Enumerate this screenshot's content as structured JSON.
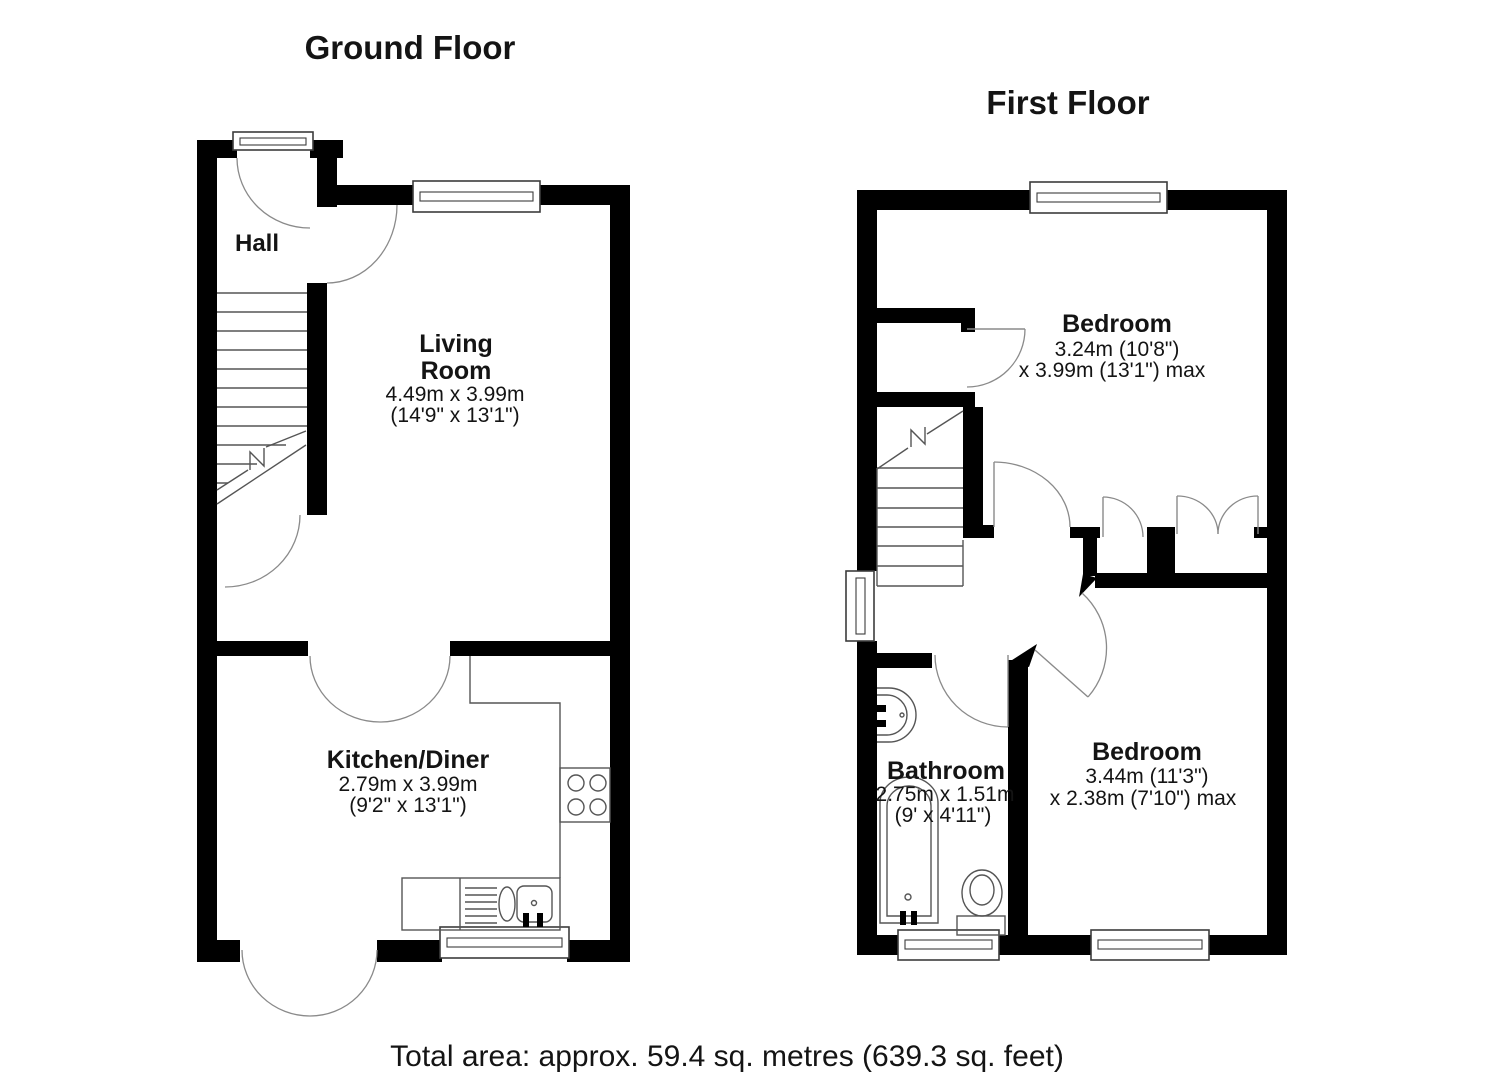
{
  "ground_floor": {
    "title": "Ground Floor",
    "hall": {
      "name": "Hall"
    },
    "living_room": {
      "name_line1": "Living",
      "name_line2": "Room",
      "dims_metric": "4.49m x 3.99m",
      "dims_imperial": "(14'9\" x 13'1\")"
    },
    "kitchen": {
      "name": "Kitchen/Diner",
      "dims_metric": "2.79m x 3.99m",
      "dims_imperial": "(9'2\" x 13'1\")"
    }
  },
  "first_floor": {
    "title": "First Floor",
    "bedroom1": {
      "name": "Bedroom",
      "dims_line1": "3.24m (10'8\")",
      "dims_line2": "x 3.99m (13'1\") max"
    },
    "bathroom": {
      "name": "Bathroom",
      "dims_metric": "2.75m x 1.51m",
      "dims_imperial": "(9' x 4'11\")"
    },
    "bedroom2": {
      "name": "Bedroom",
      "dims_line1": "3.44m (11'3\")",
      "dims_line2": "x 2.38m (7'10\") max"
    }
  },
  "footer": {
    "total_area": "Total area: approx. 59.4 sq. metres (639.3 sq. feet)"
  },
  "colors": {
    "wall": "#000000",
    "line": "#555555",
    "arc": "#8a8a8a",
    "background": "#ffffff"
  }
}
